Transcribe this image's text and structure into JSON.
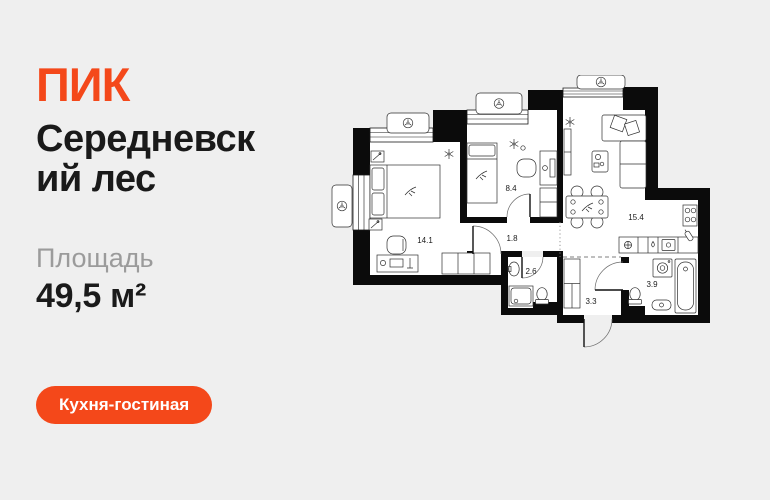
{
  "page": {
    "bg_color": "#EFEFEF",
    "accent_color": "#F4481A"
  },
  "brand": {
    "logo": "ПИК"
  },
  "listing": {
    "title_line1": "Середневск",
    "title_line2": "ий лес",
    "area_label": "Площадь",
    "area_value": "49,5 м²",
    "tag": "Кухня-гостиная"
  },
  "floorplan": {
    "room_areas": {
      "bedroom_main": "14.1",
      "bedroom_second": "8.4",
      "hall": "1.8",
      "kitchen_living": "15.4",
      "bathroom_small": "2.6",
      "entry_hall": "3.3",
      "bathroom_main": "3.9"
    }
  }
}
